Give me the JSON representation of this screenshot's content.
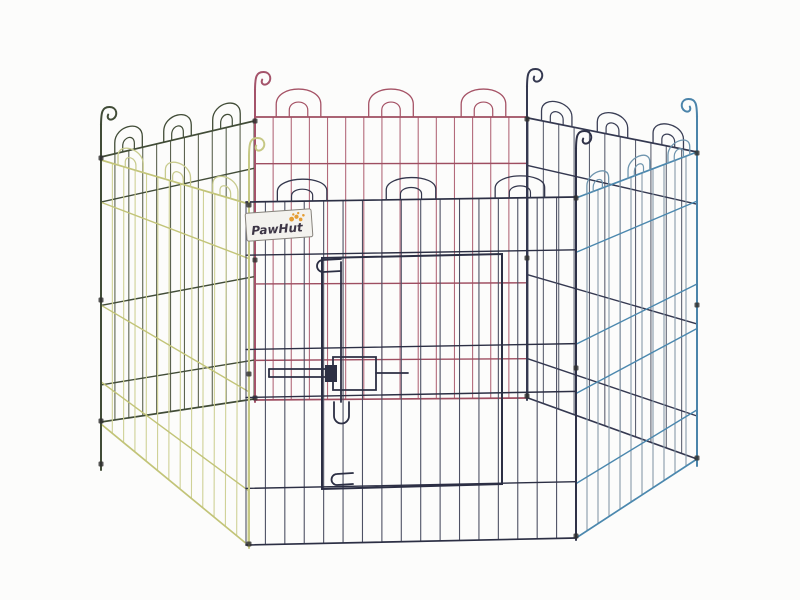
{
  "image": {
    "background": "#fcfcfb",
    "width": 800,
    "height": 600
  },
  "brand_label": {
    "text": "PawHut",
    "bg": "#f3f2ee",
    "border": "#87837c",
    "text_color": "#3c3545",
    "paw_color": "#e59d33"
  },
  "scene": {
    "panels": [
      {
        "name": "panel-back-left-green",
        "quad": [
          [
            101,
            157
          ],
          [
            254,
            121
          ],
          [
            254,
            399
          ],
          [
            101,
            422
          ]
        ],
        "wires": 12,
        "wire": "#5c6350",
        "rail": "#414c37",
        "arch": "#414c37",
        "rails": [
          0,
          0.17,
          0.56,
          0.86,
          1
        ],
        "arches": {
          "t": [
            0.18,
            0.5,
            0.82
          ],
          "h": 24,
          "hw": 0.09,
          "ih": 13,
          "ihw": 0.038
        }
      },
      {
        "name": "panel-back-middle-red",
        "quad": [
          [
            255,
            117
          ],
          [
            527,
            117
          ],
          [
            527,
            398
          ],
          [
            255,
            400
          ]
        ],
        "wires": 16,
        "wire": "#b36a7b",
        "rail": "#9e4e61",
        "arch": "#a55265",
        "rails": [
          0,
          0.165,
          0.59,
          0.86,
          1
        ],
        "arches": {
          "t": [
            0.16,
            0.5,
            0.84
          ],
          "h": 28,
          "hw": 0.082,
          "ih": 15,
          "ihw": 0.034
        }
      },
      {
        "name": "panel-back-right-navy",
        "quad": [
          [
            528,
            118
          ],
          [
            697,
            152
          ],
          [
            697,
            459
          ],
          [
            528,
            398
          ]
        ],
        "wires": 12,
        "wire": "#5e6272",
        "rail": "#343850",
        "arch": "#3a3e55",
        "rails": [
          0,
          0.17,
          0.56,
          0.86,
          1
        ],
        "arches": {
          "t": [
            0.17,
            0.5,
            0.83
          ],
          "h": 22,
          "hw": 0.09,
          "ih": 12,
          "ihw": 0.038
        }
      },
      {
        "name": "panel-front-right-blue",
        "quad": [
          [
            576,
            198
          ],
          [
            697,
            152
          ],
          [
            697,
            459
          ],
          [
            576,
            538
          ]
        ],
        "wires": 12,
        "wire": "#8799a9",
        "rail": "#4b88ae",
        "arch": "#6f95ae",
        "rails": [
          0,
          0.16,
          0.43,
          0.575,
          0.84,
          1
        ],
        "arches": {
          "t": [
            0.18,
            0.52,
            0.85
          ],
          "h": 18,
          "hw": 0.09,
          "ih": 10,
          "ihw": 0.038
        }
      },
      {
        "name": "panel-front-left-yellow",
        "quad": [
          [
            101,
            160
          ],
          [
            249,
            204
          ],
          [
            248,
            545
          ],
          [
            101,
            424
          ]
        ],
        "wires": 14,
        "wire": "#cfd196",
        "rail": "#c2c478",
        "arch": "#c8cb8e",
        "rails": [
          0,
          0.16,
          0.55,
          0.84,
          1
        ],
        "arches": {
          "t": [
            0.2,
            0.52,
            0.84
          ],
          "h": 20,
          "hw": 0.085,
          "ih": 11,
          "ihw": 0.036
        }
      },
      {
        "name": "panel-front-middle-dark",
        "quad": [
          [
            246,
            202
          ],
          [
            576,
            197
          ],
          [
            576,
            538
          ],
          [
            246,
            545
          ]
        ],
        "wires": 18,
        "wire": "#4e5164",
        "rail": "#2c2f44",
        "arch": "#33364c",
        "rails": [
          0,
          0.155,
          0.43,
          0.57,
          0.835,
          1
        ],
        "arches": {
          "t": [
            0.17,
            0.5,
            0.83
          ],
          "h": 22,
          "hw": 0.075,
          "ih": 12,
          "ihw": 0.032
        }
      }
    ],
    "posts": [
      {
        "name": "post-back-left-red",
        "layer": "back",
        "x": 255,
        "y1": 72,
        "y2": 402,
        "color": "#a4536a",
        "dir": 1,
        "r": 8,
        "clips": [
          121,
          260,
          398
        ]
      },
      {
        "name": "post-back-right-navy",
        "layer": "back",
        "x": 527,
        "y1": 69,
        "y2": 400,
        "color": "#343850",
        "dir": 1,
        "r": 8,
        "clips": [
          119,
          258,
          396
        ]
      },
      {
        "name": "post-far-left-green",
        "layer": "front",
        "x": 101,
        "y1": 107,
        "y2": 470,
        "color": "#414c37",
        "dir": 1,
        "r": 8,
        "clips": [
          158,
          300,
          421,
          464
        ]
      },
      {
        "name": "post-front-right-dark",
        "layer": "front",
        "x": 576,
        "y1": 131,
        "y2": 540,
        "color": "#2e3147",
        "dir": 1,
        "r": 8,
        "clips": [
          198,
          368,
          536
        ]
      },
      {
        "name": "post-far-right-blue",
        "layer": "front",
        "x": 697,
        "y1": 99,
        "y2": 466,
        "color": "#4b84aa",
        "dir": -1,
        "r": 8,
        "clips": [
          153,
          305,
          458
        ]
      },
      {
        "name": "post-front-left-yellow",
        "layer": "front",
        "x": 249,
        "y1": 138,
        "y2": 548,
        "color": "#c6c884",
        "dir": 1,
        "r": 8,
        "clips": [
          205,
          374,
          544
        ]
      }
    ],
    "door": {
      "name": "door-panel",
      "color": "#2c2f44",
      "frame": [
        [
          322,
          258
        ],
        [
          502,
          254
        ],
        [
          502,
          484
        ],
        [
          322,
          489
        ]
      ],
      "paths": [
        {
          "name": "door-top-hinge-loop",
          "d": "M 341 259 L 323 260 A 6 6 0 0 0 323 272 L 341 271"
        },
        {
          "name": "door-bottom-hinge-loop",
          "d": "M 353 473 L 337 474 A 5.5 5.5 0 0 0 337 485 L 353 484"
        },
        {
          "name": "door-bolt-rod",
          "d": "M 341 262 L 341 402"
        },
        {
          "name": "door-bolt-handle",
          "d": "M 334 402 L 334 416 A 7.5 7.5 0 0 0 349 416 L 349 402"
        },
        {
          "name": "latch-bar-top",
          "d": "M 269 369 L 333 369"
        },
        {
          "name": "latch-bar-bottom",
          "d": "M 269 377 L 333 377"
        },
        {
          "name": "latch-bar-left-end",
          "d": "M 269 369 L 269 377"
        },
        {
          "name": "latch-bar-right-ext",
          "d": "M 376 373 L 408 373"
        },
        {
          "name": "latch-box",
          "d": "M 333 357 L 376 357 L 376 390 L 333 390 Z"
        },
        {
          "name": "latch-block",
          "d": "M 325 365 L 337 365 L 337 382 L 325 382 Z",
          "fill": true
        }
      ]
    }
  }
}
